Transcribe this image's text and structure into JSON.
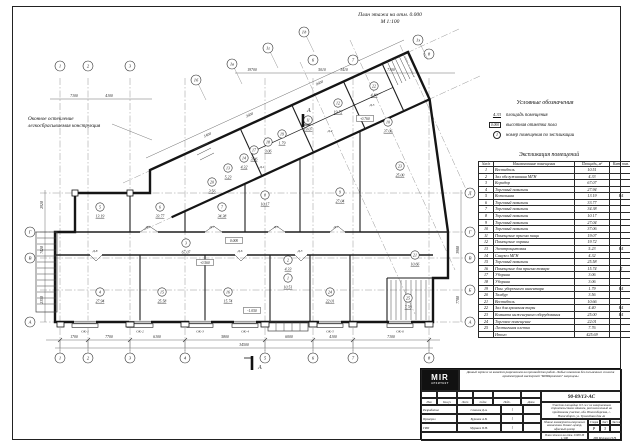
{
  "sheet": {
    "plan_title_line1": "План этажа на отм. 0.000",
    "plan_title_line2": "М 1:100",
    "note_line1": "Оконное остекление",
    "note_line2": "легкосбрасываемая конструкция"
  },
  "legend": {
    "title": "Условные обозначения",
    "items": [
      {
        "symbol": "4.33",
        "type": "area",
        "label": "площадь помещения"
      },
      {
        "symbol": "0.000",
        "type": "box",
        "label": "высотная отметка пола"
      },
      {
        "symbol": "1",
        "type": "circle",
        "label": "номер помещения по экспликации"
      }
    ]
  },
  "explication": {
    "title": "Экспликация помещений",
    "columns": [
      "№п/п",
      "Наименование помещения",
      "Площадь, м²",
      "Кат. пом."
    ],
    "rows": [
      [
        "1",
        "Вестибюль",
        "10.51",
        ""
      ],
      [
        "2",
        "Зал обслуживания МГН",
        "4.33",
        ""
      ],
      [
        "3",
        "Коридор",
        "67.07",
        ""
      ],
      [
        "4",
        "Торговый павильон",
        "27.94",
        ""
      ],
      [
        "5",
        "Котельная",
        "13.19",
        "В4"
      ],
      [
        "6",
        "Торговый павильон",
        "33.77",
        ""
      ],
      [
        "7",
        "Торговый павильон",
        "34.38",
        ""
      ],
      [
        "8",
        "Торговый павильон",
        "10.17",
        ""
      ],
      [
        "9",
        "Торговый павильон",
        "27.04",
        ""
      ],
      [
        "10",
        "Торговый павильон",
        "37.06",
        ""
      ],
      [
        "11",
        "Помещение приема пищи",
        "19.07",
        ""
      ],
      [
        "12",
        "Помещение охраны",
        "19.72",
        ""
      ],
      [
        "13",
        "Электрощитовая",
        "5.23",
        "В4"
      ],
      [
        "14",
        "Санузел МГН",
        "4.32",
        ""
      ],
      [
        "15",
        "Торговый павильон",
        "25.58",
        ""
      ],
      [
        "16",
        "Помещение для приема товара",
        "15.74",
        "Д"
      ],
      [
        "17",
        "Уборная",
        "3.06",
        ""
      ],
      [
        "18",
        "Уборная",
        "3.06",
        ""
      ],
      [
        "19",
        "Пом. уборочного инвентаря",
        "1.79",
        "В4"
      ],
      [
        "20",
        "Тамбур",
        "3.56",
        ""
      ],
      [
        "21",
        "Вестибюль",
        "10.66",
        ""
      ],
      [
        "22",
        "Зал для хранения тары",
        "4.40",
        "В4"
      ],
      [
        "23",
        "Комната инженерного оборудования",
        "25.00",
        "В4"
      ],
      [
        "24",
        "Торговое помещение",
        "22.01",
        ""
      ],
      [
        "25",
        "Лестничная клетка",
        "7.76",
        ""
      ]
    ],
    "total_label": "Итого",
    "total_value": "425.69"
  },
  "titleblock": {
    "logo_main": "MIR",
    "logo_sub": "АРХИТЕКТ",
    "notice": "Данный чертеж не является разрешением на производство работ. Любые изменения без письменного согласия архитектурной мастерской \"МИРАрхитект\" запрещены",
    "doc_number": "90-09/13-АС",
    "site_text": "Участок площадью 0.3 га с не завершенным строительством зданием, расположенный на придомовом участке, обл. Новосибирская, г. Новосибирск, ул. Троллейная дом 4а",
    "object_text": "Здание коммерческо-торгового назначения. Бизнес-центр, офисный центр",
    "sheet_title": "План этажа на отм. 0.000",
    "sheet_scale": "М 1:100",
    "stage_label": "Стадия",
    "sheet_label": "Лист",
    "sheets_label": "Листов",
    "stage": "Р",
    "sheet_no": "3",
    "sheets_total": "",
    "firm": "ИП Мурзаев П.Н.",
    "sig_header": [
      "Изм",
      "Кол.уч",
      "Лист",
      "№док",
      "Подп.",
      "Дата"
    ],
    "signatures": [
      {
        "role": "Разработал",
        "name": "Соколов Д.А.",
        "sign": "⌇"
      },
      {
        "role": "Проверил",
        "name": "Буранов А.В.",
        "sign": "⌇"
      },
      {
        "role": "ГИП",
        "name": "Мурзаев П.Н.",
        "sign": "⌇"
      }
    ]
  },
  "plan": {
    "section_label": "А",
    "axes_bottom": [
      {
        "n": "1",
        "x": 60
      },
      {
        "n": "2",
        "x": 88
      },
      {
        "n": "3",
        "x": 130
      },
      {
        "n": "4",
        "x": 185
      },
      {
        "n": "5",
        "x": 265
      },
      {
        "n": "6",
        "x": 313
      },
      {
        "n": "7",
        "x": 353
      },
      {
        "n": "8",
        "x": 429
      }
    ],
    "axes_top": [
      {
        "n": "1",
        "x": 60,
        "y": 66
      },
      {
        "n": "2",
        "x": 88,
        "y": 66
      },
      {
        "n": "3",
        "x": 130,
        "y": 66
      },
      {
        "n": "6",
        "x": 313,
        "y": 60
      },
      {
        "n": "7",
        "x": 353,
        "y": 60
      },
      {
        "n": "8",
        "x": 429,
        "y": 54
      }
    ],
    "axes_left": [
      {
        "n": "Г",
        "y": 232
      },
      {
        "n": "В",
        "y": 258
      },
      {
        "n": "А",
        "y": 322
      }
    ],
    "axes_right": [
      {
        "n": "Д",
        "y": 193
      },
      {
        "n": "Г",
        "y": 232
      },
      {
        "n": "В",
        "y": 258
      },
      {
        "n": "Б",
        "y": 290
      },
      {
        "n": "А",
        "y": 322
      }
    ],
    "axes_diag": [
      {
        "n": "1б",
        "x": 196,
        "y": 80
      },
      {
        "n": "1в",
        "x": 232,
        "y": 64
      },
      {
        "n": "1г",
        "x": 268,
        "y": 48
      },
      {
        "n": "1д",
        "x": 304,
        "y": 32
      },
      {
        "n": "1з",
        "x": 418,
        "y": 40
      }
    ],
    "rooms": [
      {
        "n": "1",
        "area": "10.51",
        "x": 288,
        "y": 278
      },
      {
        "n": "2",
        "area": "4.33",
        "x": 288,
        "y": 260
      },
      {
        "n": "3",
        "area": "67.07",
        "x": 186,
        "y": 243
      },
      {
        "n": "4",
        "area": "27.94",
        "x": 100,
        "y": 292
      },
      {
        "n": "5",
        "area": "13.19",
        "x": 100,
        "y": 207
      },
      {
        "n": "6",
        "area": "33.77",
        "x": 160,
        "y": 207
      },
      {
        "n": "7",
        "area": "34.38",
        "x": 222,
        "y": 207
      },
      {
        "n": "8",
        "area": "10.17",
        "x": 265,
        "y": 195
      },
      {
        "n": "9",
        "area": "27.04",
        "x": 340,
        "y": 192
      },
      {
        "n": "10",
        "area": "37.06",
        "x": 388,
        "y": 122
      },
      {
        "n": "11",
        "area": "19.07",
        "x": 308,
        "y": 120
      },
      {
        "n": "12",
        "area": "19.72",
        "x": 338,
        "y": 103
      },
      {
        "n": "13",
        "area": "5.23",
        "x": 228,
        "y": 168
      },
      {
        "n": "14",
        "area": "4.32",
        "x": 244,
        "y": 158
      },
      {
        "n": "15",
        "area": "25.58",
        "x": 162,
        "y": 292
      },
      {
        "n": "16",
        "area": "15.74",
        "x": 228,
        "y": 292
      },
      {
        "n": "17",
        "area": "3.06",
        "x": 254,
        "y": 150
      },
      {
        "n": "18",
        "area": "3.06",
        "x": 268,
        "y": 142
      },
      {
        "n": "19",
        "area": "1.79",
        "x": 282,
        "y": 134
      },
      {
        "n": "20",
        "area": "3.56",
        "x": 212,
        "y": 182
      },
      {
        "n": "21",
        "area": "10.66",
        "x": 415,
        "y": 255
      },
      {
        "n": "22",
        "area": "4.40",
        "x": 374,
        "y": 86
      },
      {
        "n": "23",
        "area": "25.00",
        "x": 400,
        "y": 166
      },
      {
        "n": "24",
        "area": "22.01",
        "x": 330,
        "y": 292
      },
      {
        "n": "25",
        "area": "7.76",
        "x": 408,
        "y": 298
      }
    ],
    "doors": [
      {
        "t": "Д-7",
        "x": 148,
        "y": 228
      },
      {
        "t": "Д-7",
        "x": 212,
        "y": 228
      },
      {
        "t": "Д-7",
        "x": 276,
        "y": 228
      },
      {
        "t": "Д-7",
        "x": 336,
        "y": 228
      },
      {
        "t": "Д-8",
        "x": 95,
        "y": 252
      },
      {
        "t": "Д-6",
        "x": 240,
        "y": 252
      },
      {
        "t": "Д-3",
        "x": 300,
        "y": 252
      },
      {
        "t": "Д-1",
        "x": 262,
        "y": 168
      },
      {
        "t": "Д-2",
        "x": 330,
        "y": 132
      },
      {
        "t": "Д-5",
        "x": 372,
        "y": 106
      }
    ],
    "windows": [
      {
        "t": "ОК-1",
        "x": 85
      },
      {
        "t": "ОК-2",
        "x": 140
      },
      {
        "t": "ОК-3",
        "x": 200
      },
      {
        "t": "ОК-4",
        "x": 245
      },
      {
        "t": "ОК-5",
        "x": 330
      },
      {
        "t": "ОК-6",
        "x": 400
      }
    ],
    "elevations": [
      {
        "t": "0.000",
        "x": 234,
        "y": 242
      },
      {
        "t": "-0.560",
        "x": 205,
        "y": 264
      },
      {
        "t": "-1.050",
        "x": 252,
        "y": 312
      },
      {
        "t": "-0.760",
        "x": 365,
        "y": 120
      }
    ],
    "dim_labels": [
      {
        "t": "1700",
        "x": 74,
        "y": 338
      },
      {
        "t": "7700",
        "x": 109,
        "y": 338
      },
      {
        "t": "6100",
        "x": 157,
        "y": 338
      },
      {
        "t": "5800",
        "x": 225,
        "y": 338
      },
      {
        "t": "6000",
        "x": 289,
        "y": 338
      },
      {
        "t": "4100",
        "x": 333,
        "y": 338
      },
      {
        "t": "7100",
        "x": 391,
        "y": 338
      },
      {
        "t": "34500",
        "x": 244,
        "y": 346
      },
      {
        "t": "7100",
        "x": 74,
        "y": 97
      },
      {
        "t": "4100",
        "x": 109,
        "y": 97
      },
      {
        "t": "19700",
        "x": 252,
        "y": 71
      },
      {
        "t": "5010",
        "x": 322,
        "y": 71
      },
      {
        "t": "3410",
        "x": 344,
        "y": 71
      },
      {
        "t": "7100",
        "x": 391,
        "y": 71
      },
      {
        "t": "2350",
        "x": 43,
        "y": 300,
        "r": -90
      },
      {
        "t": "7420",
        "x": 43,
        "y": 250,
        "r": -90
      },
      {
        "t": "2920",
        "x": 43,
        "y": 205,
        "r": -90
      },
      {
        "t": "7700",
        "x": 459,
        "y": 300,
        "r": -90
      },
      {
        "t": "3900",
        "x": 459,
        "y": 250,
        "r": -90
      },
      {
        "t": "5400",
        "x": 208,
        "y": 136,
        "r": -25
      },
      {
        "t": "3600",
        "x": 250,
        "y": 116,
        "r": -25
      },
      {
        "t": "9600",
        "x": 320,
        "y": 84,
        "r": -25
      }
    ]
  }
}
